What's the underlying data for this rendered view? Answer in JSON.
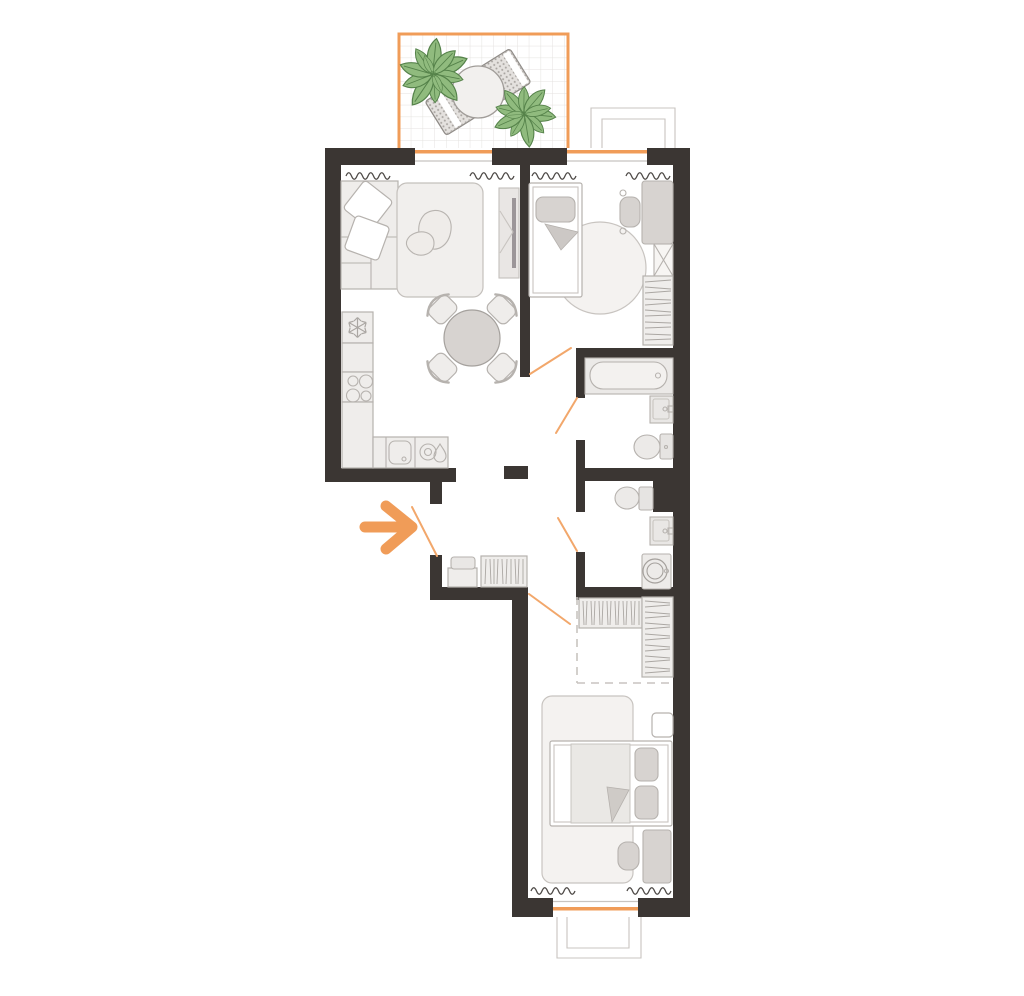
{
  "canvas": {
    "width": 1024,
    "height": 996
  },
  "colors": {
    "background": "#FFFFFF",
    "white": "#FFFFFF",
    "wall": "#3B3633",
    "accent": "#F09C58",
    "doorswing": "#F2A76B",
    "furnfill": "#EFEDEB",
    "furnmid": "#D7D3D0",
    "furnstroke": "#B6B2AE",
    "thinline": "#C8C4C0",
    "rugfill": "#F4F2F0",
    "radiator": "#4E4A47",
    "grid": "#E4E2DF",
    "hatch": "#ABA7A3",
    "plantfill": "#90BB7E",
    "plantstroke": "#55824A",
    "benchfill": "#E4E1DE",
    "benchstroke": "#8F8B87",
    "tvbar": "#9C9699"
  },
  "icons": {
    "entrance_arrow": "→",
    "fridge_snowflake": "❄",
    "sink_drop": "💧"
  },
  "plan": {
    "type": "apartment-floor-plan",
    "orientation": "vertical",
    "rooms": [
      {
        "id": "terrace",
        "features": [
          "plant",
          "plant",
          "round-garden-table",
          "woven-lounger"
        ]
      },
      {
        "id": "living-room-kitchen",
        "features": [
          "corner-sofa",
          "two-pillows",
          "sofa-bed",
          "tv-unit",
          "round-dining-table",
          "four-chairs",
          "fridge",
          "stove",
          "kitchen-counter",
          "kitchen-sink",
          "radiator",
          "radiator"
        ]
      },
      {
        "id": "kids-room",
        "features": [
          "single-bed",
          "pillow",
          "blanket-fold",
          "round-rug",
          "desk",
          "desk-chair",
          "wardrobe",
          "shelving",
          "radiator",
          "radiator"
        ]
      },
      {
        "id": "bathroom",
        "features": [
          "bathtub",
          "wash-basin",
          "toilet"
        ]
      },
      {
        "id": "wc",
        "features": [
          "toilet",
          "wash-basin",
          "washing-machine",
          "duct-shaft"
        ]
      },
      {
        "id": "hallway",
        "features": [
          "entrance-arrow",
          "bench",
          "wardrobe"
        ]
      },
      {
        "id": "bedroom",
        "features": [
          "walk-in-closet",
          "closet-rail",
          "closet-rail",
          "rug",
          "double-bed",
          "two-pillows",
          "blanket-fold",
          "bedside-table",
          "desk",
          "chair",
          "radiator",
          "radiator"
        ]
      }
    ],
    "doors": [
      "entrance",
      "kids-room",
      "bathroom",
      "wc",
      "bedroom"
    ],
    "windows": [
      "living-room",
      "kids-room",
      "bedroom"
    ],
    "balconies": [
      "terrace-top",
      "juliet-top-right",
      "balcony-bottom"
    ]
  }
}
